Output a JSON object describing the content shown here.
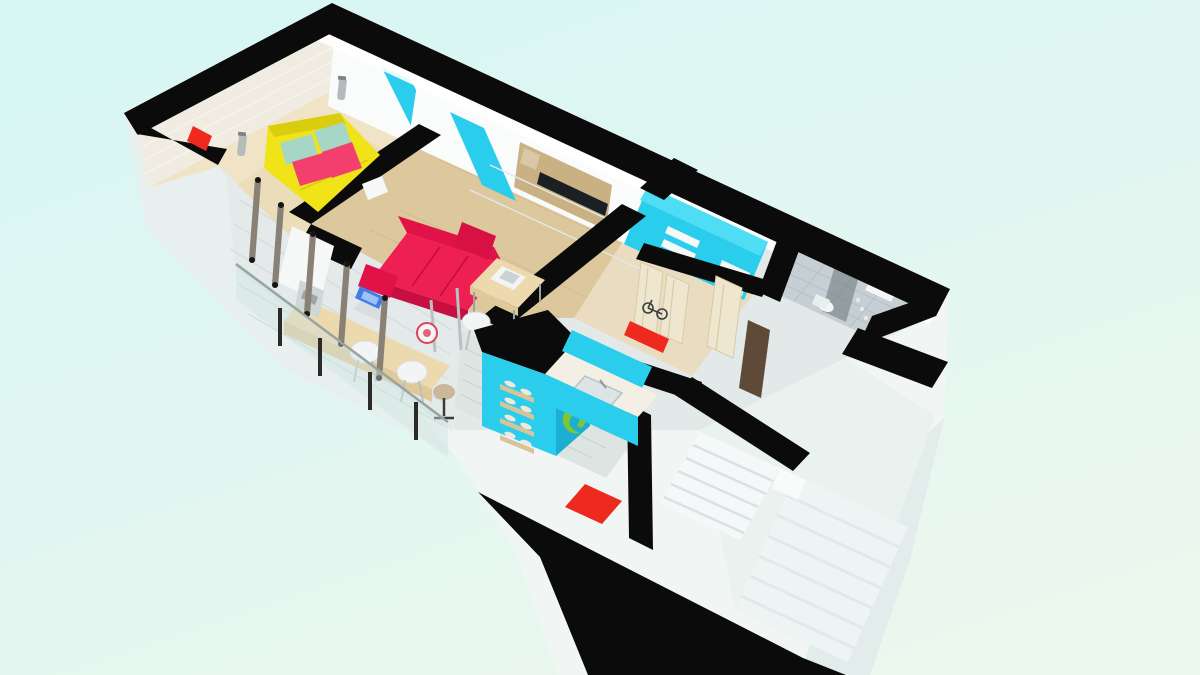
{
  "meta": {
    "title": "3D floor plan render — one-bedroom apartment, isometric cutaway view",
    "width_px": 1200,
    "height_px": 675,
    "visible_text": ""
  },
  "colors": {
    "background_top": "#d7f6f4",
    "background_bottom": "#ecf7ee",
    "wall_cut": "#0b0b0b",
    "exterior_white": "#f1f6f5",
    "exterior_shade": "#e7f0ee",
    "exterior_shade2": "#e2ecea",
    "floor_plank": "#e2e9e8",
    "floor_wood": "#ddc79d",
    "floor_wood_light": "#f0e3c6",
    "floor_tile": "#dde5e2",
    "floor_hall": "#e9dcc0",
    "brick_wall": "#f1ece2",
    "unit_white": "#fafcfb",
    "unit_top": "#eef2f1",
    "accent_cyan": "#2bcdec",
    "accent_cyan_dark": "#1daed3",
    "accent_cyan_bright": "#4fdcf5",
    "sofa_red": "#ee2053",
    "sofa_red_dark": "#c70f42",
    "bed_yellow": "#f0e418",
    "bed_yellow_dark": "#d9cd0e",
    "pillow_teal": "#a6d7c6",
    "pillow_pink": "#f33f6d",
    "accent_red": "#ee2a1e",
    "door_cream": "#efe6cf",
    "door_brown": "#5f4a38",
    "decal_green": "#7cc832",
    "wood_furniture": "#ecd9ae",
    "niche_wood": "#c9b183",
    "tv_black": "#1b2024",
    "glass": "#cfe2e0",
    "metal": "#b5babc",
    "post_dark": "#2a2a28",
    "frame_taupe": "#8a8176",
    "stair_white": "#f4f8f8",
    "stair_faint": "#edf4f3",
    "shower_tile": "#c6d0d4",
    "laptop_screen": "#3f7ee9"
  },
  "scene": {
    "type": "architectural-3d-floor-plan",
    "view": "isometric cutaway seen from above, rotated diagonally",
    "rooms": [
      {
        "name": "bedroom",
        "floor": "light wood",
        "items": [
          "double bed with yellow duvet",
          "teal pillows",
          "pink pillows",
          "white brick accent wall",
          "two wall sconces",
          "closet with cyan sliding door",
          "red wall accent",
          "white side shelf"
        ]
      },
      {
        "name": "living-room",
        "floor": "wood",
        "items": [
          "red sofa",
          "wood coffee table",
          "white media wall unit",
          "tv",
          "tall cyan wardrobe door",
          "wood shelf niche"
        ]
      },
      {
        "name": "dining-office",
        "floor": "white planks",
        "items": [
          "wood desk",
          "laptop",
          "white shell chairs",
          "bar stool",
          "coffee machine",
          "red decorative plate"
        ]
      },
      {
        "name": "kitchen",
        "floor": "gray tile",
        "items": [
          "cyan island with wall bottle racks",
          "green vine wall decal",
          "white counter with sink",
          "red floor mat"
        ]
      },
      {
        "name": "hallway",
        "floor": "beige",
        "items": [
          "cream interior doors",
          "red bench",
          "bicycle",
          "brown entrance door"
        ]
      },
      {
        "name": "bathroom",
        "walls": "cyan",
        "items": [
          "towel shelves",
          "white washbasin unit"
        ]
      },
      {
        "name": "shower-room",
        "walls": "gray tile",
        "items": [
          "glass shower enclosure",
          "shower column",
          "toilet"
        ]
      },
      {
        "name": "balcony",
        "items": [
          "glass railing with dark posts",
          "slim window frames"
        ]
      },
      {
        "name": "staircase",
        "items": [
          "upper flight",
          "lower flight descending outside the slab"
        ]
      }
    ]
  }
}
